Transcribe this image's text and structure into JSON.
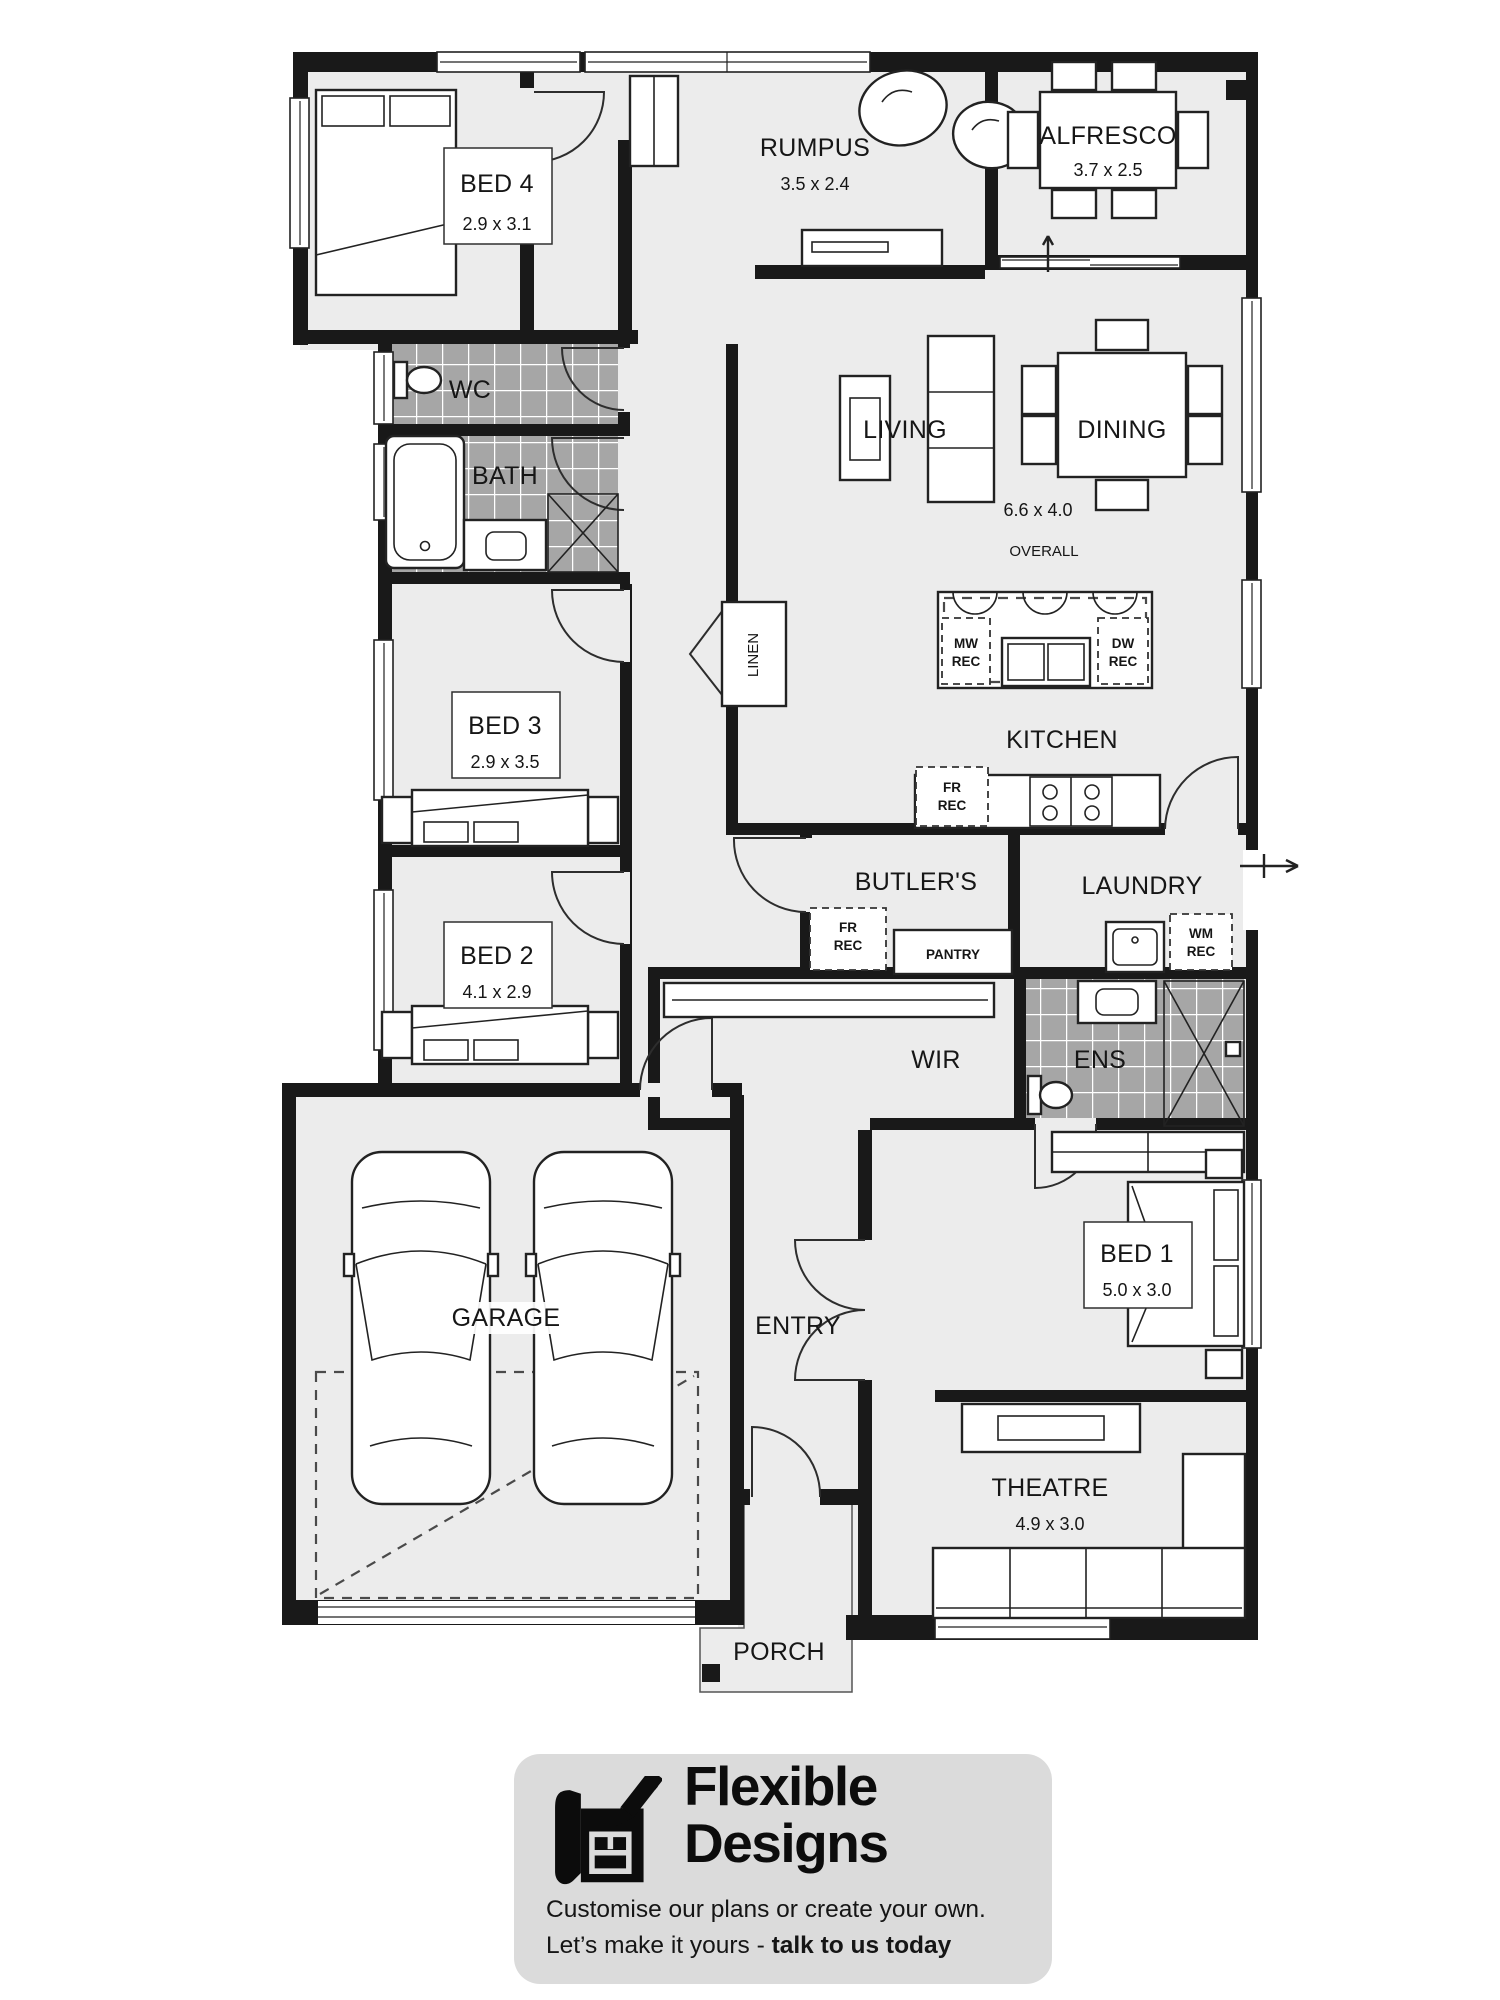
{
  "plan": {
    "rooms": {
      "bed4": {
        "label": "BED 4",
        "dims": "2.9 x 3.1"
      },
      "rumpus": {
        "label": "RUMPUS",
        "dims": "3.5 x 2.4"
      },
      "alfresco": {
        "label": "ALFRESCO",
        "dims": "3.7 x 2.5"
      },
      "wc": {
        "label": "WC"
      },
      "bath": {
        "label": "BATH"
      },
      "living": {
        "label": "LIVING"
      },
      "dining": {
        "label": "DINING"
      },
      "living_dining_dims": "6.6 x 4.0",
      "living_dining_note": "OVERALL",
      "kitchen": {
        "label": "KITCHEN"
      },
      "linen": {
        "label": "LINEN"
      },
      "bed3": {
        "label": "BED 3",
        "dims": "2.9 x 3.5"
      },
      "bed2": {
        "label": "BED 2",
        "dims": "4.1 x 2.9"
      },
      "butlers": {
        "label": "BUTLER'S"
      },
      "pantry": {
        "label": "PANTRY"
      },
      "laundry": {
        "label": "LAUNDRY"
      },
      "wir": {
        "label": "WIR"
      },
      "ens": {
        "label": "ENS"
      },
      "garage": {
        "label": "GARAGE"
      },
      "entry": {
        "label": "ENTRY"
      },
      "bed1": {
        "label": "BED 1",
        "dims": "5.0 x 3.0"
      },
      "theatre": {
        "label": "THEATRE",
        "dims": "4.9 x 3.0"
      },
      "porch": {
        "label": "PORCH"
      }
    },
    "recesses": {
      "mw": [
        "MW",
        "REC"
      ],
      "dw": [
        "DW",
        "REC"
      ],
      "fr_kitchen": [
        "FR",
        "REC"
      ],
      "fr_butlers": [
        "FR",
        "REC"
      ],
      "wm": [
        "WM",
        "REC"
      ]
    }
  },
  "footer": {
    "brand_line1": "Flexible",
    "brand_line2": "Designs",
    "tagline": "Customise our plans or create your own.",
    "cta_prefix": "Let’s make it yours - ",
    "cta_bold": "talk to us today"
  },
  "colors": {
    "wall": "#191919",
    "floor": "#ececec",
    "tile": "#a6a6a6",
    "badge_bg": "#dbdbdb"
  }
}
